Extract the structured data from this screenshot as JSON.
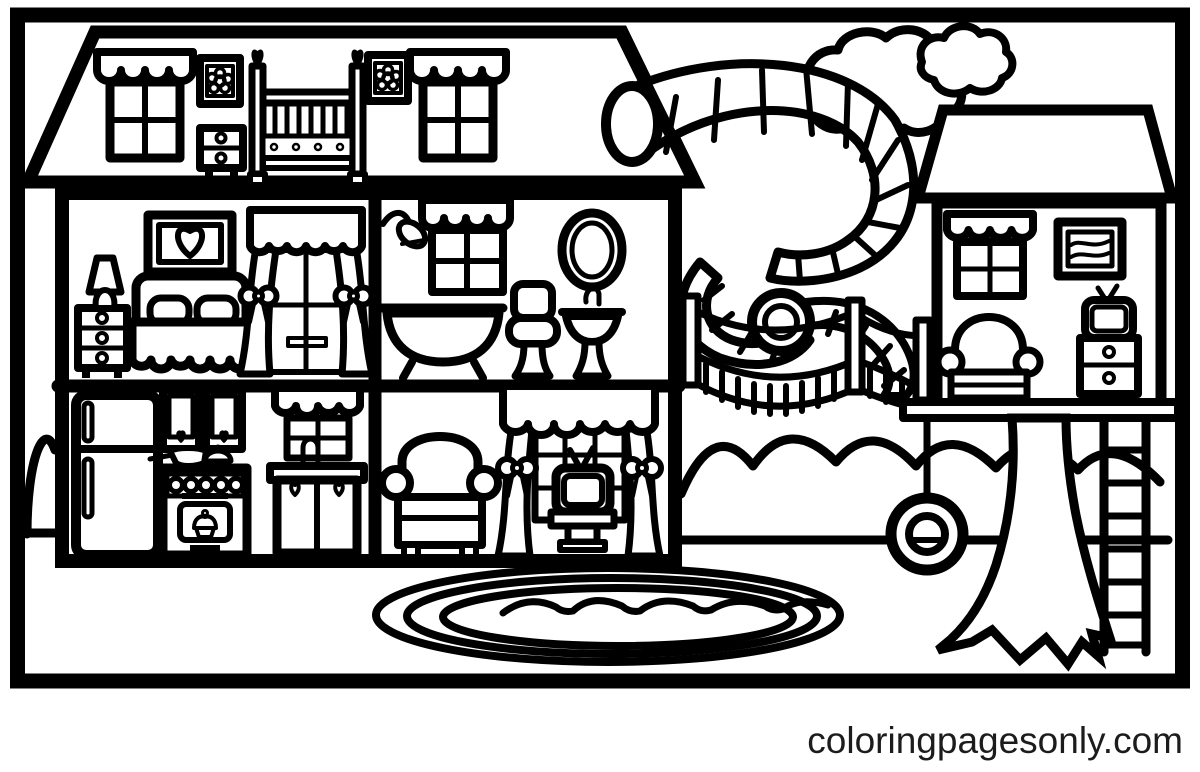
{
  "watermark": {
    "text": "coloringpagesonly.com",
    "color": "#1c1c1c"
  },
  "palette": {
    "line": "#000000",
    "background": "#ffffff"
  },
  "scene": {
    "type": "coloring-page",
    "elements": [
      "dollhouse",
      "attic-nursery",
      "bedroom",
      "bathroom",
      "kitchen",
      "living-room",
      "spiral-water-slide",
      "rope-bridge",
      "treehouse",
      "tree",
      "tire-swing",
      "ladder",
      "pond",
      "clouds",
      "hedge"
    ]
  }
}
